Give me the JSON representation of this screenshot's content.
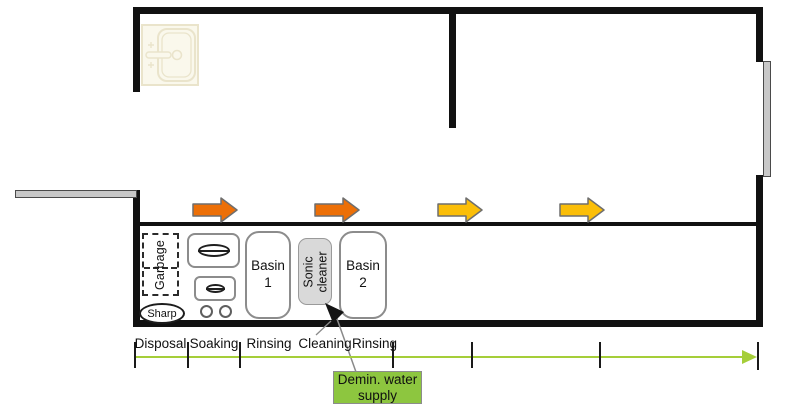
{
  "colors": {
    "wall": "#111111",
    "door_gray": "#c8c8c8",
    "flow_orange": "#EC6F07",
    "flow_yellow": "#FBBE08",
    "arrow_outline": "#6e6e6e",
    "timeline_green": "#A5CE39",
    "supply_green": "#8DC63F",
    "equipment_gray": "#D9D9D9",
    "sink_cream": "#FAF8EC",
    "sink_stroke": "#EAE4CB"
  },
  "counter": {
    "garbage": "Garbage",
    "sharp": "Sharp",
    "basin1": "Basin 1",
    "sonic_cleaner": "Sonic cleaner",
    "basin2": "Basin 2"
  },
  "stages": [
    "Disposal",
    "Soaking",
    "Rinsing",
    "Cleaning",
    "Rinsing"
  ],
  "annotation": {
    "demin_label": "Demin. water supply"
  }
}
